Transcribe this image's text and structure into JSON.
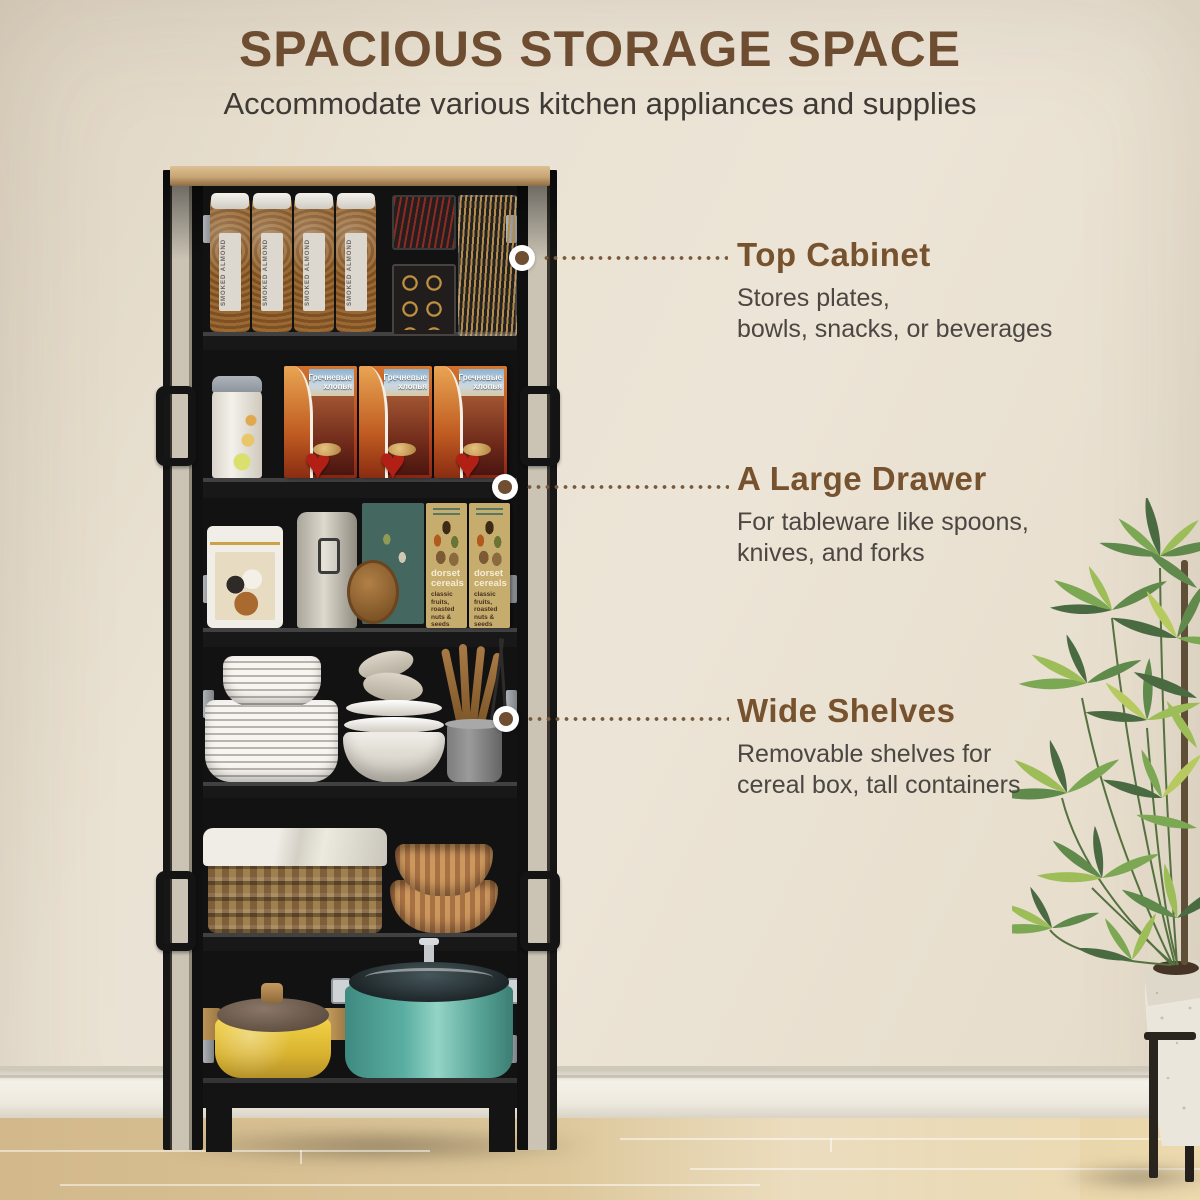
{
  "header": {
    "title": "SPACIOUS STORAGE SPACE",
    "subtitle": "Accommodate various kitchen appliances and supplies"
  },
  "callouts": [
    {
      "title": "Top Cabinet",
      "lines": [
        "Stores plates,",
        "bowls, snacks, or beverages"
      ]
    },
    {
      "title": "A Large Drawer",
      "lines": [
        "For tableware like spoons,",
        "knives, and forks"
      ]
    },
    {
      "title": "Wide Shelves",
      "lines": [
        "Removable shelves for",
        "cereal box, tall containers"
      ]
    }
  ],
  "products": {
    "jar_label": "SMOKED ALMOND",
    "cereal_box_line1": "Гречневые",
    "cereal_box_line2": "хлопья",
    "dorset_name": "dorset cereals",
    "dorset_desc": "classic fruits, roasted nuts & seeds"
  },
  "colors": {
    "accent_brown": "#6f4e32",
    "heading_brown": "#77522e",
    "body_text": "#4b4742",
    "wall_beige": "#e8e0d1",
    "cabinet_black": "#141414",
    "wood_top": "#c9a873",
    "floor_wood": "#dcc497"
  }
}
